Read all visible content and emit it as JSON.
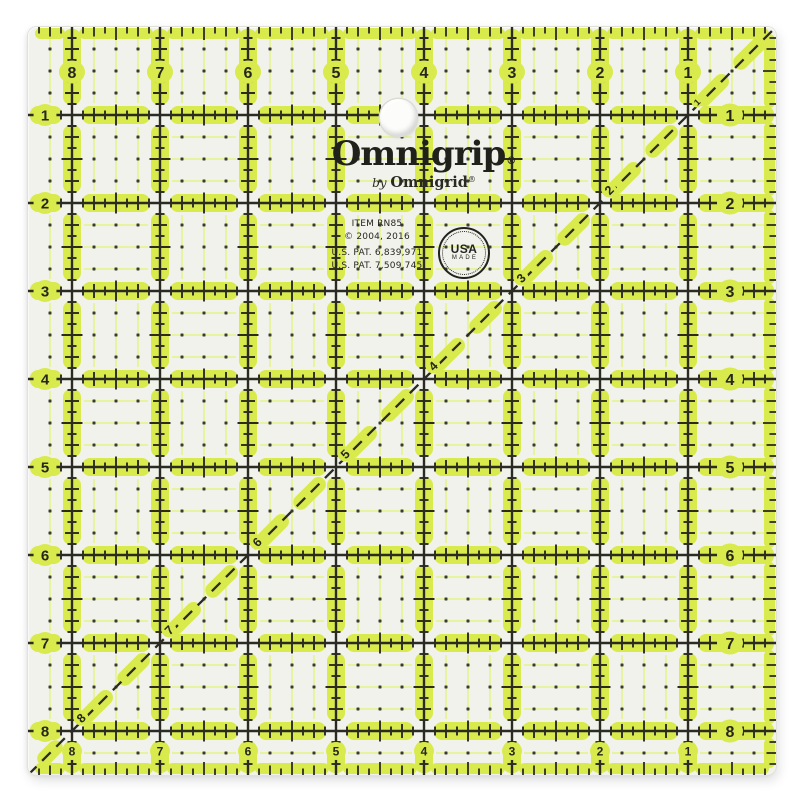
{
  "branding": {
    "logo": "Omnigrip",
    "logo_reg": "®",
    "byline_prefix": "by ",
    "byline_name": "Omnigrid",
    "byline_reg": "®"
  },
  "info": {
    "item": "ITEM RN85",
    "copyright": "© 2004, 2016",
    "patents": [
      "U.S. PAT. 6,839,971",
      "U.S. PAT. 7,509,745"
    ]
  },
  "usa_badge": {
    "line1": "USA",
    "line2": "MADE"
  },
  "scales": {
    "top": [
      "8",
      "7",
      "6",
      "5",
      "4",
      "3",
      "2",
      "1"
    ],
    "bottom": [
      "8",
      "7",
      "6",
      "5",
      "4",
      "3",
      "2",
      "1"
    ],
    "left": [
      "1",
      "2",
      "3",
      "4",
      "5",
      "6",
      "7",
      "8"
    ],
    "right": [
      "1",
      "2",
      "3",
      "4",
      "5",
      "6",
      "7",
      "8"
    ],
    "diagonal": [
      "1",
      "2",
      "3",
      "4",
      "5",
      "6",
      "7",
      "8"
    ]
  },
  "colors": {
    "highlight": "#d9ea4d",
    "highlight_soft": "#e8f3a2",
    "dot": "#3a3a30",
    "ink": "#2b2b24",
    "surface": "#f1f2eb",
    "background": "#ffffff",
    "text": "#22221c"
  }
}
